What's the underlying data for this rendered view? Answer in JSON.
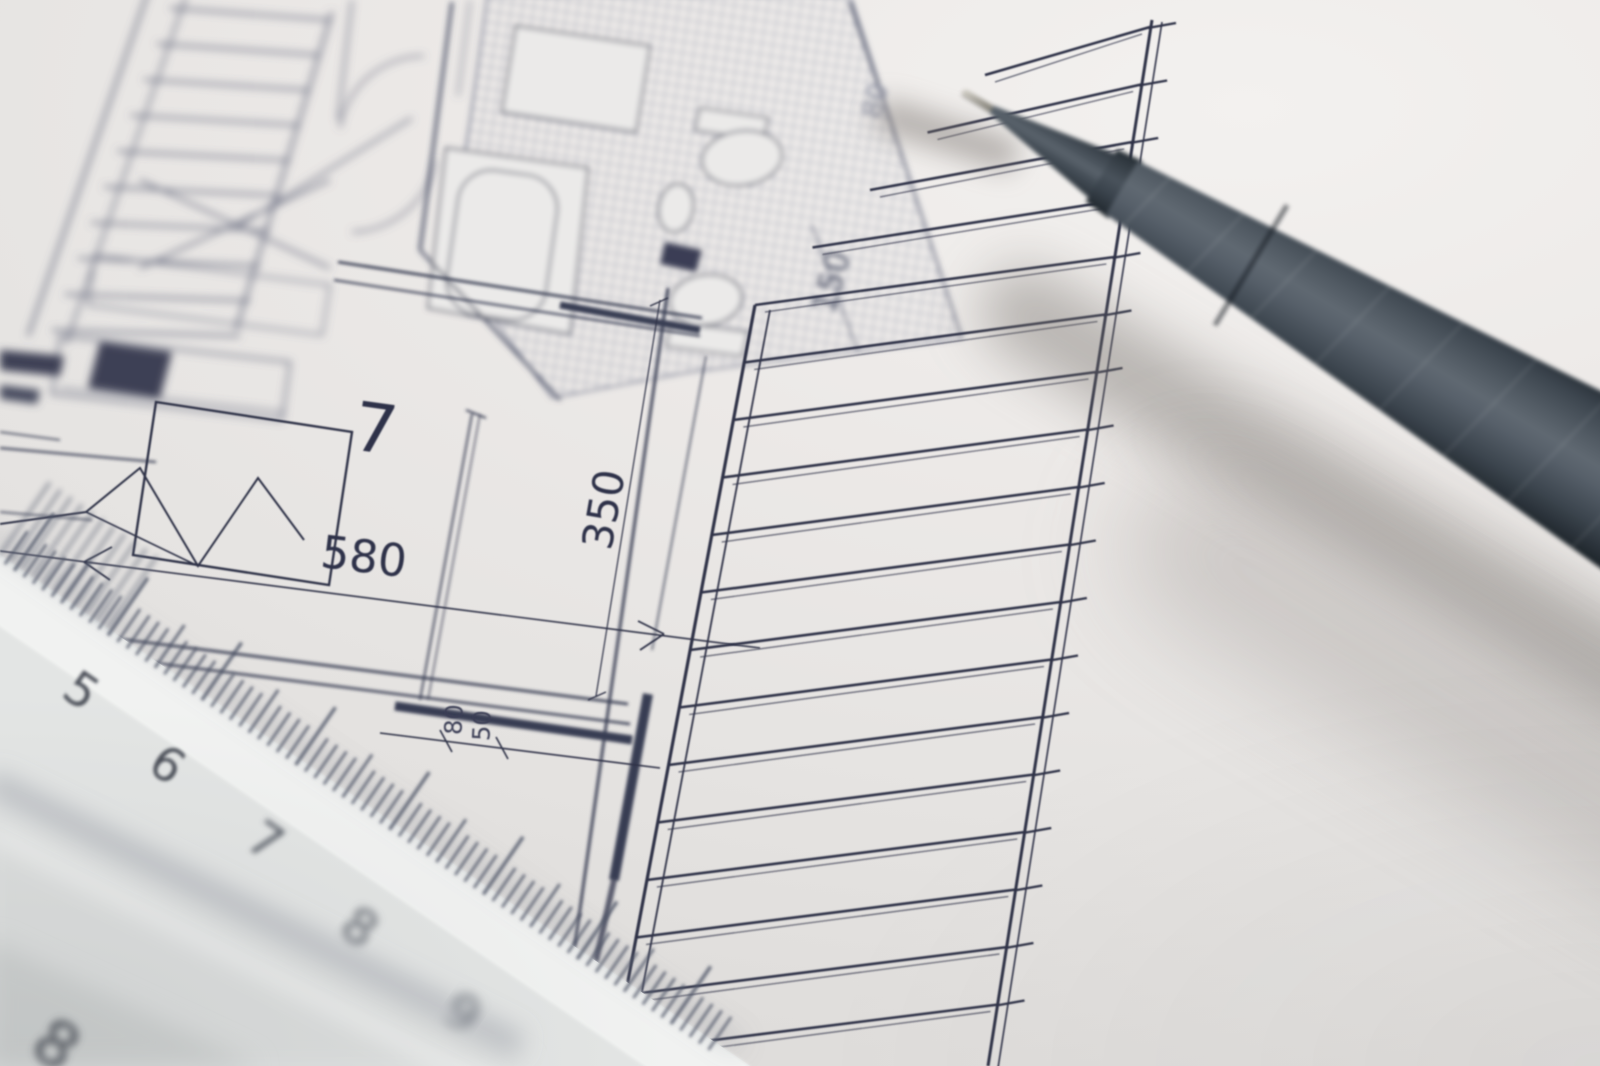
{
  "scene": {
    "type": "photograph",
    "subject": "architectural floor plan drawing on paper with a fineliner pen and a scale ruler",
    "paper_color": "#eae8e6",
    "ink_color": "#2e3147",
    "pen_color": "#4c555e",
    "ruler_color": "#e3e5e4"
  },
  "floor_plan": {
    "room_number": "7",
    "dim_bed": "580",
    "dim_depth": "350",
    "dim_small_a": "80",
    "dim_small_b": "50",
    "dim_bath": "150",
    "dim_top": "80"
  },
  "ruler": {
    "numbers": [
      "5",
      "6",
      "7",
      "8",
      "9"
    ],
    "corner_number": "8"
  }
}
